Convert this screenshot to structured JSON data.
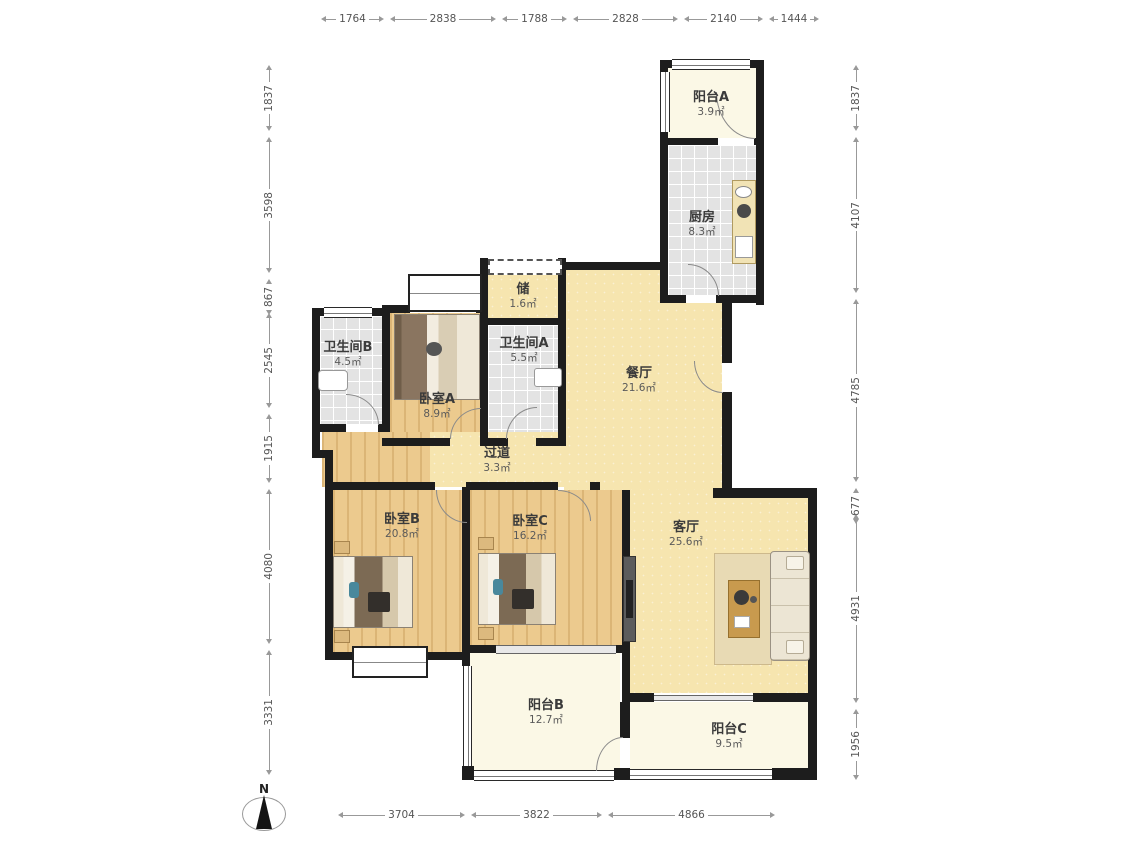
{
  "title": "户型图",
  "dimensions": {
    "top": [
      "1764",
      "2838",
      "1788",
      "2828",
      "2140",
      "1444"
    ],
    "left": [
      "1837",
      "3598",
      "867",
      "2545",
      "1915",
      "4080",
      "3331"
    ],
    "right": [
      "1837",
      "4107",
      "4785",
      "677",
      "4931",
      "1956"
    ],
    "bottom": [
      "3704",
      "3822",
      "4866"
    ]
  },
  "rooms": {
    "balcony_a": {
      "name": "阳台A",
      "area": "3.9㎡"
    },
    "kitchen": {
      "name": "厨房",
      "area": "8.3㎡"
    },
    "storage": {
      "name": "储",
      "area": "1.6㎡"
    },
    "bath_a": {
      "name": "卫生间A",
      "area": "5.5㎡"
    },
    "bath_b": {
      "name": "卫生间B",
      "area": "4.5㎡"
    },
    "bedroom_a": {
      "name": "卧室A",
      "area": "8.9㎡"
    },
    "dining": {
      "name": "餐厅",
      "area": "21.6㎡"
    },
    "hallway": {
      "name": "过道",
      "area": "3.3㎡"
    },
    "bedroom_b": {
      "name": "卧室B",
      "area": "20.8㎡"
    },
    "bedroom_c": {
      "name": "卧室C",
      "area": "16.2㎡"
    },
    "living": {
      "name": "客厅",
      "area": "25.6㎡"
    },
    "balcony_b": {
      "name": "阳台B",
      "area": "12.7㎡"
    },
    "balcony_c": {
      "name": "阳台C",
      "area": "9.5㎡"
    }
  },
  "compass": {
    "label": "N"
  },
  "colors": {
    "wall": "#1d1d1d",
    "wood_floor": "#ecca8e",
    "tile_floor": "#e3e3e3",
    "warm_floor": "#f6e5af",
    "balcony_floor": "#fbf8e6"
  }
}
